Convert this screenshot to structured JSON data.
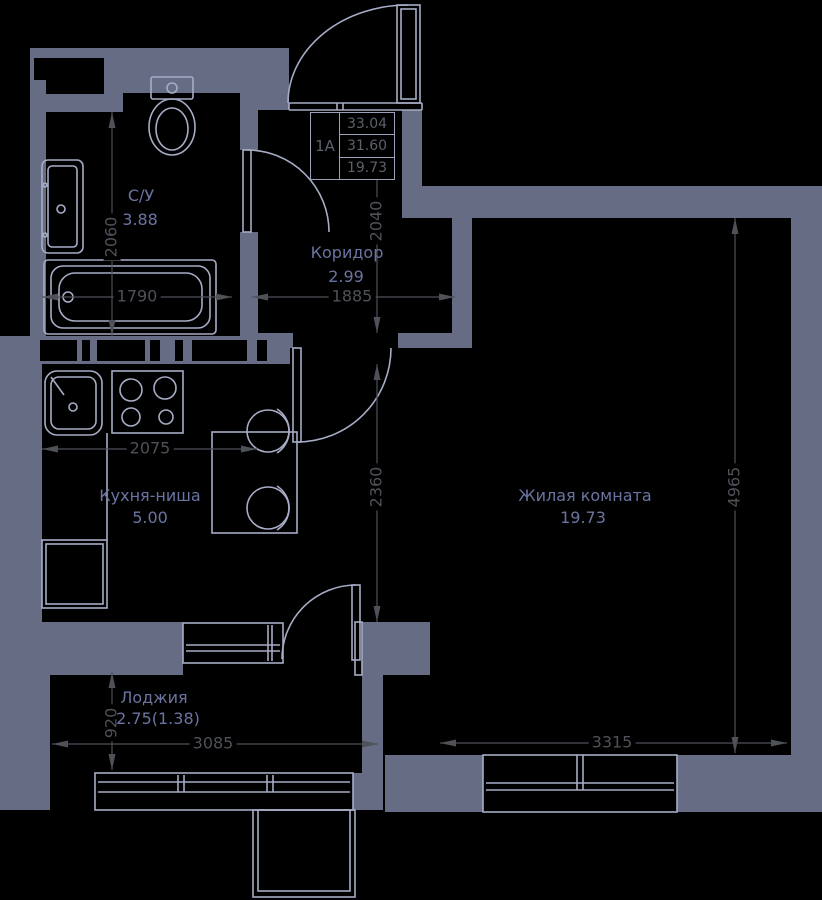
{
  "plan": {
    "unit_box": {
      "unit": "1А",
      "values": [
        "33.04",
        "31.60",
        "19.73"
      ]
    },
    "rooms": [
      {
        "name": "С/У",
        "area": "3.88"
      },
      {
        "name": "Коридор",
        "area": "2.99"
      },
      {
        "name": "Кухня-ниша",
        "area": "5.00"
      },
      {
        "name": "Жилая комната",
        "area": "19.73"
      },
      {
        "name": "Лоджия",
        "area": "2.75(1.38)"
      }
    ],
    "dimensions": {
      "bath_height": "2060",
      "bath_width": "1790",
      "corridor_width": "1885",
      "corridor_height": "2040",
      "kitchen_zone_height": "2360",
      "kitchen_width": "2075",
      "living_height": "4965",
      "loggia_depth": "920",
      "loggia_width": "3085",
      "living_width": "3315"
    },
    "colors": {
      "background": "#000000",
      "wall": "#656c83",
      "line": "#a6acc6",
      "dimension": "#4e5158",
      "room_label": "#6b74a1",
      "box_text": "#5c606b",
      "box_border": "#9aa0b8"
    }
  }
}
